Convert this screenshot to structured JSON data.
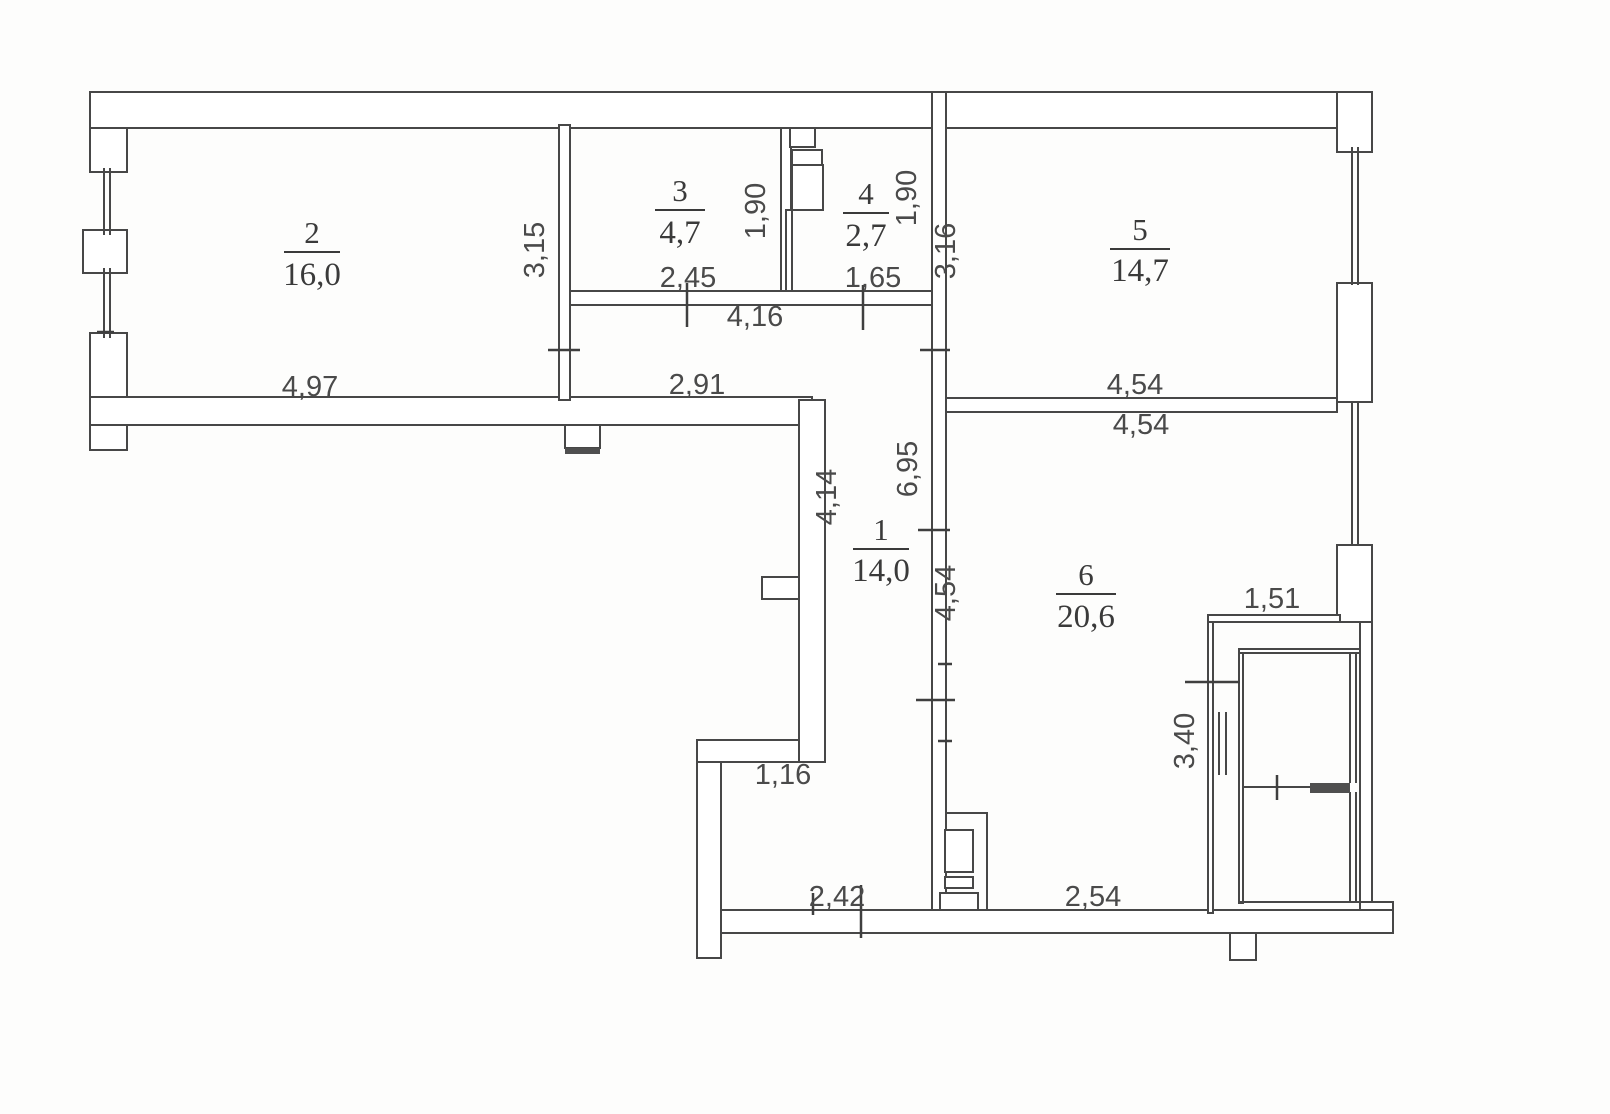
{
  "plan": {
    "type": "apartment-floor-plan",
    "rooms": [
      {
        "number": "1",
        "area": "14,0"
      },
      {
        "number": "2",
        "area": "16,0"
      },
      {
        "number": "3",
        "area": "4,7"
      },
      {
        "number": "4",
        "area": "2,7"
      },
      {
        "number": "5",
        "area": "14,7"
      },
      {
        "number": "6",
        "area": "20,6"
      }
    ],
    "dimensions": {
      "room2_width": "4,97",
      "room2_height": "3,15",
      "room3_width": "2,45",
      "room3_height": "1,90",
      "room4_width": "1,65",
      "room4_height": "1,90",
      "room5_width": "4,54",
      "room5_height": "3,16",
      "room6_top_width": "4,54",
      "room6_left_height": "4,54",
      "corridor_top_width": "4,16",
      "corridor_mid_width": "2,91",
      "corridor_left_height": "4,14",
      "corridor_right_height": "6,95",
      "entry_niche_width": "1,16",
      "entry_bottom_width": "2,42",
      "room6_bottom_width": "2,54",
      "loggia_width": "1,51",
      "loggia_height": "3,40"
    }
  }
}
